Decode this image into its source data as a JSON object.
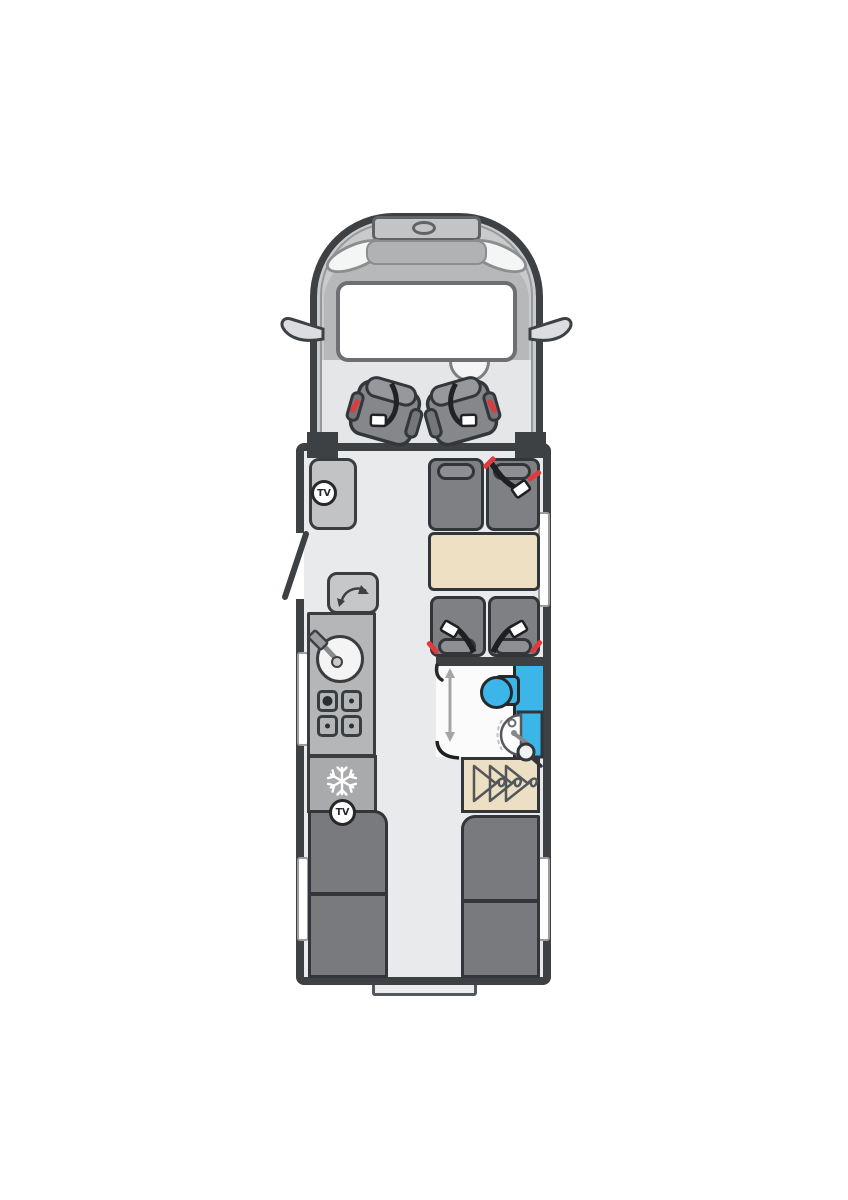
{
  "title": "Motorhome floor plan (top view)",
  "labels": {
    "tv": "TV"
  },
  "colors": {
    "outline": "#3e4144",
    "body": "#c9cacc",
    "cowl": "#b7b8ba",
    "floor": "#e9eaec",
    "kitchen": "#b5b6b8",
    "fridge": "#a9aaac",
    "cabinet": "#c2c3c5",
    "seat": "#7e8083",
    "seat_pill": "#8d8f92",
    "dark_unit": "#787a7d",
    "cream": "#ecdfc3",
    "table_cream": "#eee0c2",
    "blue": "#3cb6e8",
    "red": "#e03a3f",
    "belt_black": "#1d1f21",
    "white": "#ffffff",
    "window_frame": "#9a9c9e"
  },
  "zones": {
    "cab": {
      "name": "Driver's cab",
      "features": [
        "bonnet",
        "roof-vent",
        "badge",
        "headlight-left",
        "headlight-right",
        "windscreen",
        "wing-mirror-left",
        "wing-mirror-right",
        "steering-wheel",
        "swivel-seat-with-belt-left",
        "swivel-seat-with-belt-right"
      ]
    },
    "lounge": {
      "name": "Half-dinette lounge",
      "features": [
        "tv-cabinet-with-tv-point",
        "travel-seat-plain",
        "travel-seat-belted",
        "travel-seat-belted",
        "travel-seat-belted",
        "dinette-table"
      ]
    },
    "entrance": {
      "name": "Habitation door shown open"
    },
    "kitchen": {
      "name": "Kitchen",
      "features": [
        "worktop-flap-with-swing-arrow",
        "round-sink-with-tap",
        "four-burner-hob",
        "fridge-freezer",
        "tv-point"
      ]
    },
    "washroom": {
      "name": "Washroom",
      "features": [
        "sliding-door-indicator",
        "toilet",
        "fold-down-basin",
        "shower-cubicle",
        "shower-head"
      ]
    },
    "wardrobe": {
      "name": "Wardrobe",
      "features": [
        "coat-hanger",
        "coat-hanger",
        "coat-hanger"
      ]
    },
    "bedroom": {
      "name": "Rear twin single beds",
      "features": [
        "single-bed-left",
        "single-bed-right"
      ]
    },
    "exterior": {
      "window_count": 4,
      "rear_step_count": 1
    }
  }
}
